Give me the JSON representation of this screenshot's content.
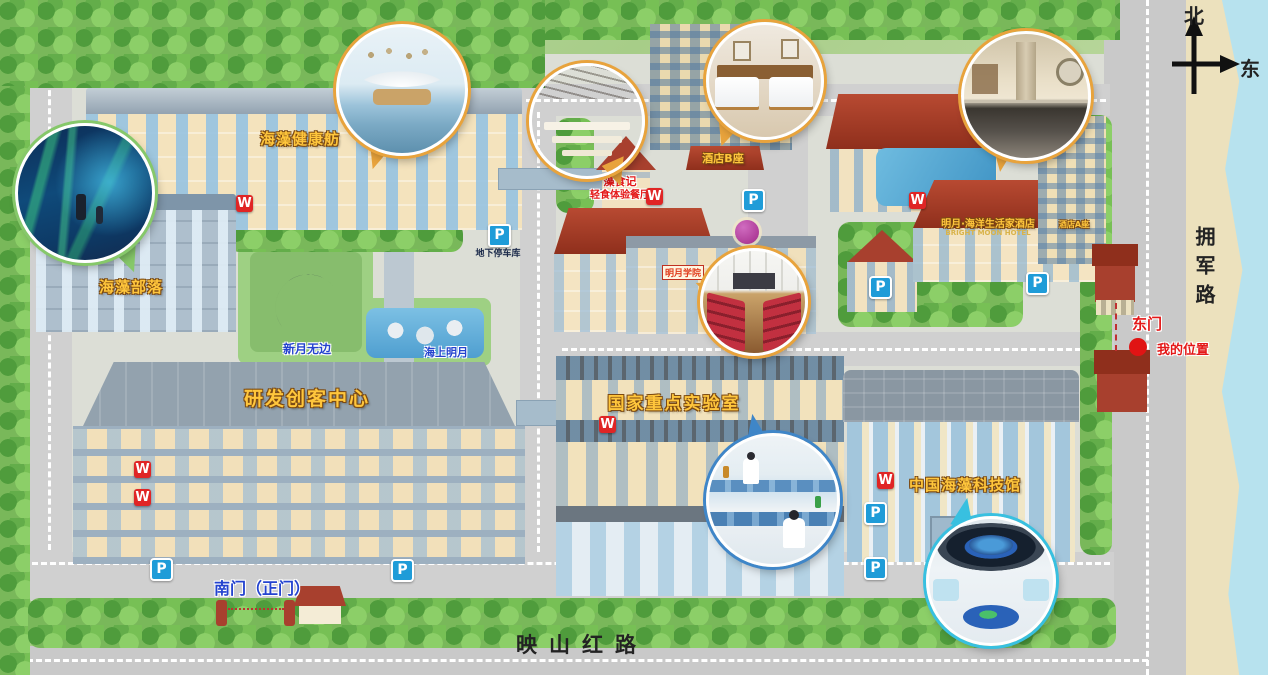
{
  "compass": {
    "north": "北",
    "east": "东"
  },
  "roads": {
    "east_vertical": "拥军路",
    "south_horizontal": "映山红路"
  },
  "labels": {
    "health_pavilion": "海藻健康舫",
    "seaweed_tribe": "海藻部落",
    "maker_center": "研发创客中心",
    "crescent_sculpture": "新月无边",
    "sea_moon_pond": "海上明月",
    "restaurant_name": "藻食记",
    "restaurant_subtitle": "轻食体验餐厅",
    "college": "明月学院",
    "hotel_tower_b": "酒店B座",
    "hotel_name": "明月·海洋生活家酒店",
    "hotel_name_en": "BRIGHT MOON HOTEL",
    "hotel_tower_a": "酒店A座",
    "national_lab": "国家重点实验室",
    "science_museum": "中国海藻科技馆"
  },
  "gates": {
    "south_gate": "南门（正门）",
    "east_gate": "东门"
  },
  "location": {
    "my_location": "我的位置"
  },
  "markers": {
    "toilet": "W",
    "parking": "P",
    "underground_parking": "地下停车库"
  },
  "colors": {
    "gold_label": "#ffc63c",
    "red_label": "#e41818",
    "blue_label": "#2443cf",
    "toilet_marker": "#e02525",
    "parking_marker": "#1f9cd8",
    "red_roof": "#a8402e",
    "sea": "#b7e2ee",
    "road": "#c9c9c9"
  }
}
